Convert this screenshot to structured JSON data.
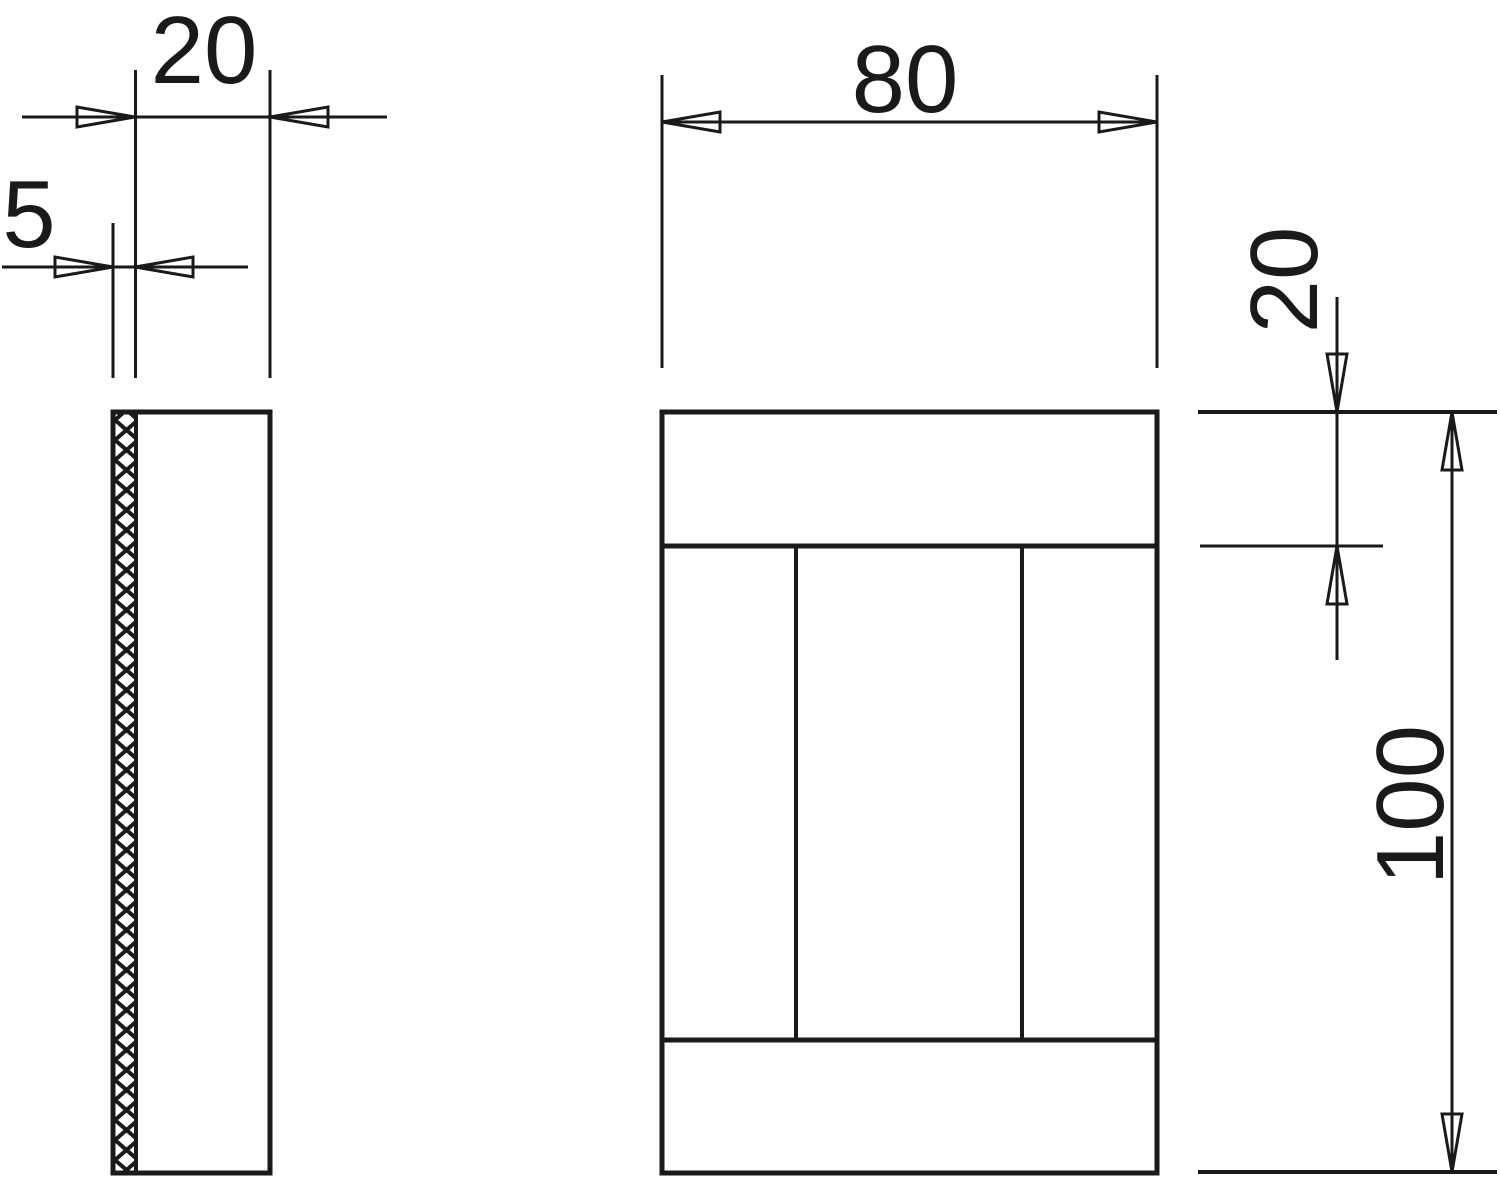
{
  "colors": {
    "background": "#ffffff",
    "line": "#1a1a1a"
  },
  "dimensions": {
    "side_width": {
      "label": "20"
    },
    "layer_thickness": {
      "label": "5"
    },
    "front_width": {
      "label": "80"
    },
    "band_height": {
      "label": "20"
    },
    "front_height": {
      "label": "100"
    }
  }
}
